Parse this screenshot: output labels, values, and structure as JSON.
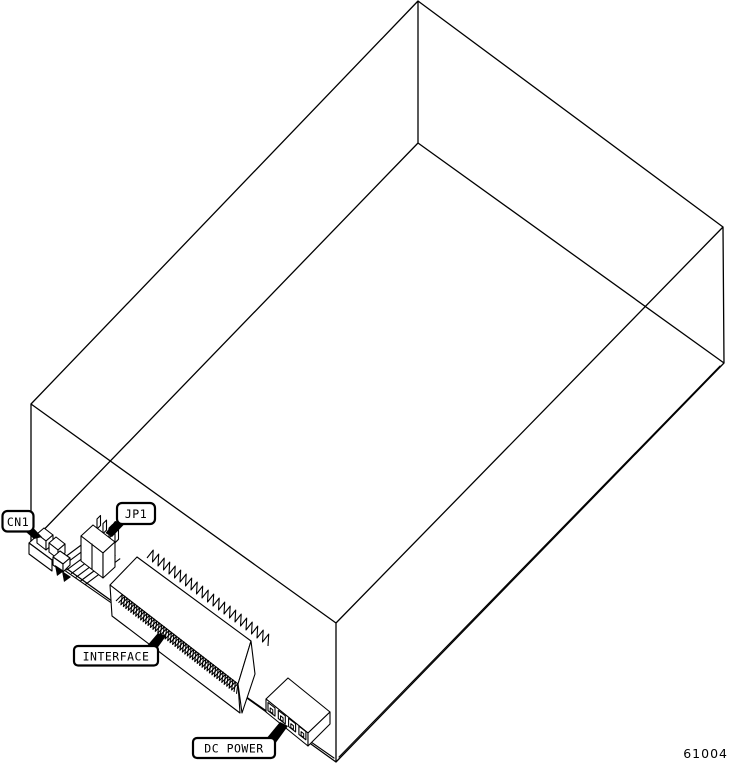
{
  "diagram": {
    "title_hidden": "",
    "callouts": {
      "cn1": {
        "label": "CN1"
      },
      "jp1": {
        "label": "JP1"
      },
      "interface": {
        "label": "INTERFACE"
      },
      "dc_power": {
        "label": "DC POWER"
      }
    },
    "figure_number": "61004",
    "line_color": "#000000",
    "background_color": "#ffffff",
    "parts": [
      "drive-chassis-isometric",
      "cn1-connector",
      "jp1-jumper-block",
      "ribbon-cable",
      "interface-edge-connector",
      "dc-power-connector"
    ]
  }
}
